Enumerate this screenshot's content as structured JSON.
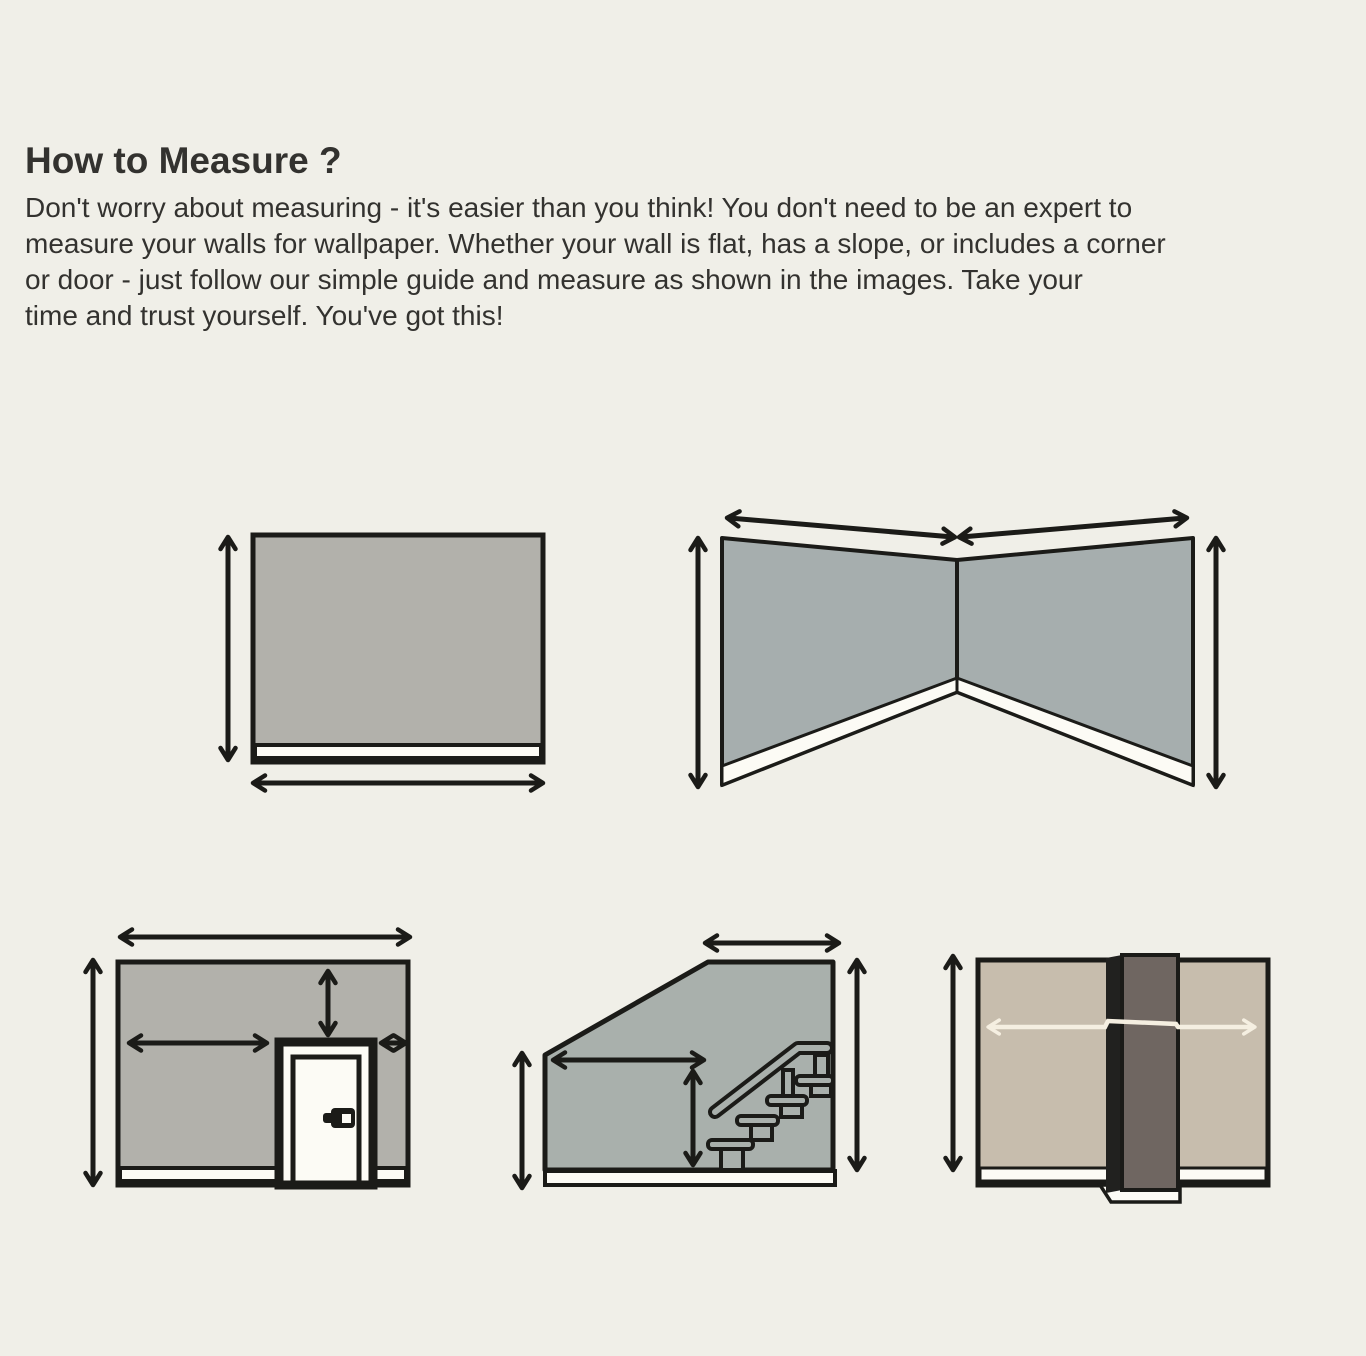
{
  "header": {
    "title": "How to Measure ?",
    "intro_lines": [
      "Don't worry about measuring - it's easier than you think! You don't need to be an expert to",
      "measure your walls for wallpaper. Whether your wall is flat, has a slope, or includes a corner",
      "or door - just follow our simple guide and measure as shown in the images. Take your",
      "time and trust yourself. You've got this!"
    ]
  },
  "diagrams": [
    "flat-wall",
    "corner-walls",
    "wall-with-door",
    "staircase-wall",
    "wall-with-column"
  ],
  "colors": {
    "background": "#f0efe8",
    "text": "#33322f",
    "outline": "#1b1b18",
    "wall_gray": "#b2b1ab",
    "wall_bluegray": "#a6aeae",
    "wall_greengray": "#a9b0ac",
    "wall_beige": "#c7bdad",
    "column_face": "#6f6661",
    "column_shadow": "#21211f",
    "trim_white": "#fcfbf5",
    "arrow_black": "#1b1b18",
    "arrow_cream": "#f5efe1"
  }
}
